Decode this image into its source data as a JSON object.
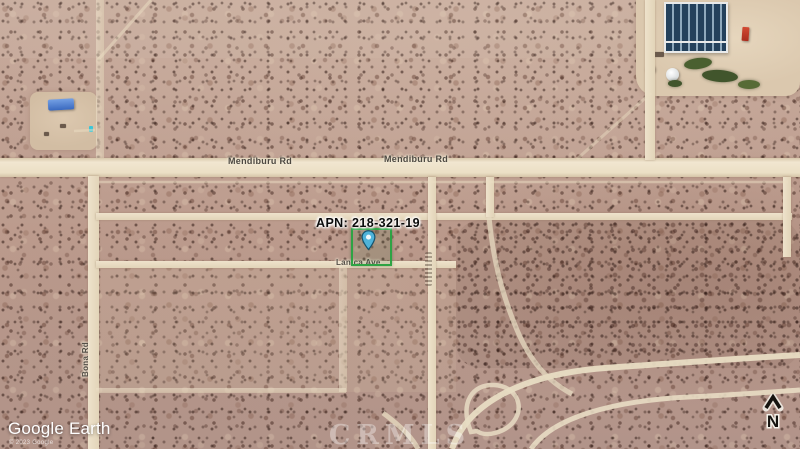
{
  "map": {
    "parcel": {
      "apn_label": "APN: 218-321-19"
    },
    "road_labels": {
      "mendiburu_west": "Mendiburu Rd",
      "mendiburu_east": "Mendiburu Rd",
      "lanica": "Lanica Ave",
      "bona": "Bona Rd"
    },
    "watermarks": {
      "google_earth": "Google Earth",
      "copyright_small": "© 2023 Google",
      "mls": "CRMLS"
    },
    "compass": {
      "north": "N"
    },
    "colors": {
      "terrain": "#bb9a8c",
      "road": "#eadfc8",
      "parcel_outline": "#2ea344",
      "pin_fill": "#4fb3d9",
      "greenhouse_panel": "#24415c"
    }
  }
}
